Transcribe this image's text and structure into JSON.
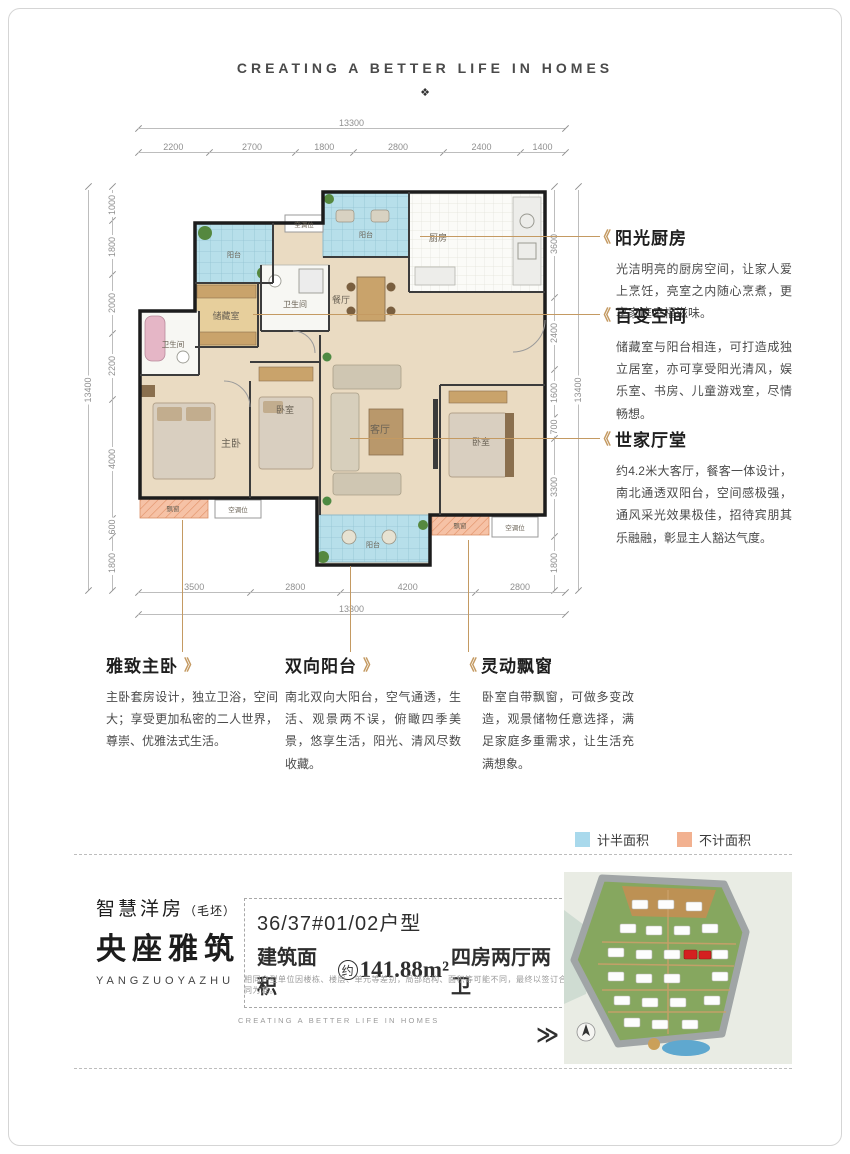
{
  "header": {
    "tagline": "CREATING A BETTER LIFE IN HOMES",
    "ornament": "❖"
  },
  "icons": {
    "chevron_left": "《",
    "chevron_right": "》",
    "double_chevron": "≫"
  },
  "plan": {
    "rooms": {
      "balcony": "阳台",
      "ac": "空调位",
      "kitchen": "厨房",
      "dining": "餐厅",
      "bath": "卫生间",
      "storage": "储藏室",
      "master": "主卧",
      "bedroom": "卧室",
      "living": "客厅",
      "bay": "飘窗"
    },
    "dims": {
      "top_total": "13300",
      "top": [
        "2200",
        "2700",
        "1800",
        "2800",
        "2400",
        "1400"
      ],
      "left_total": "13400",
      "left": [
        "1000",
        "1800",
        "2000",
        "2200",
        "4000",
        "600",
        "1800"
      ],
      "right": [
        "3600",
        "2400",
        "1600",
        "700",
        "3300",
        "1800"
      ],
      "right_total": "13400",
      "bottom": [
        "3500",
        "2800",
        "4200",
        "2800"
      ],
      "bottom_total": "13300"
    }
  },
  "callouts": {
    "kitchen": {
      "title": "阳光厨房",
      "body": "光洁明亮的厨房空间，让家人爱上烹饪，亮室之内随心烹煮，更享家庭幸福滋味。"
    },
    "flex": {
      "title": "百变空间",
      "body": "储藏室与阳台相连，可打造成独立居室，亦可享受阳光清风，娱乐室、书房、儿童游戏室，尽情畅想。"
    },
    "living": {
      "title": "世家厅堂",
      "body": "约4.2米大客厅，餐客一体设计，南北通透双阳台，空间感极强，通风采光效果极佳，招待宾朋其乐融融，彰显主人豁达气度。"
    },
    "master": {
      "title": "雅致主卧",
      "body": "主卧套房设计，独立卫浴，空间大；享受更加私密的二人世界，尊崇、优雅法式生活。"
    },
    "balcony": {
      "title": "双向阳台",
      "body": "南北双向大阳台，空气通透，生活、观景两不误，俯瞰四季美景，悠享生活，阳光、清风尽数收藏。"
    },
    "bay": {
      "title": "灵动飘窗",
      "body": "卧室自带飘窗，可做多变改造，观景储物任意选择，满足家庭多重需求，让生活充满想象。"
    }
  },
  "legend": {
    "half": {
      "label": "计半面积",
      "color": "#a9d9ec"
    },
    "excluded": {
      "label": "不计面积",
      "color": "#f2b190"
    }
  },
  "brand": {
    "line1": "智慧洋房",
    "line1_suffix": "（毛坯）",
    "name": "央座雅筑",
    "pinyin": "YANGZUOYAZHU",
    "footer_tagline": "CREATING A BETTER LIFE IN HOMES"
  },
  "unit": {
    "line1": "36/37#01/02户型",
    "area_prefix": "建筑面积",
    "approx": "约",
    "area_value": "141.88m²",
    "layout": "四房两厅两卫",
    "disclaimer": "相同户型单位因楼栋、楼层、单元等差别，局部结构、面积等可能不同，最终以签订合同为准。"
  },
  "colors": {
    "accent_tan": "#c49a62",
    "wall": "#1c1c1c",
    "balcony_blue": "#b7dfea",
    "bay_salmon": "#f6c2a6"
  }
}
